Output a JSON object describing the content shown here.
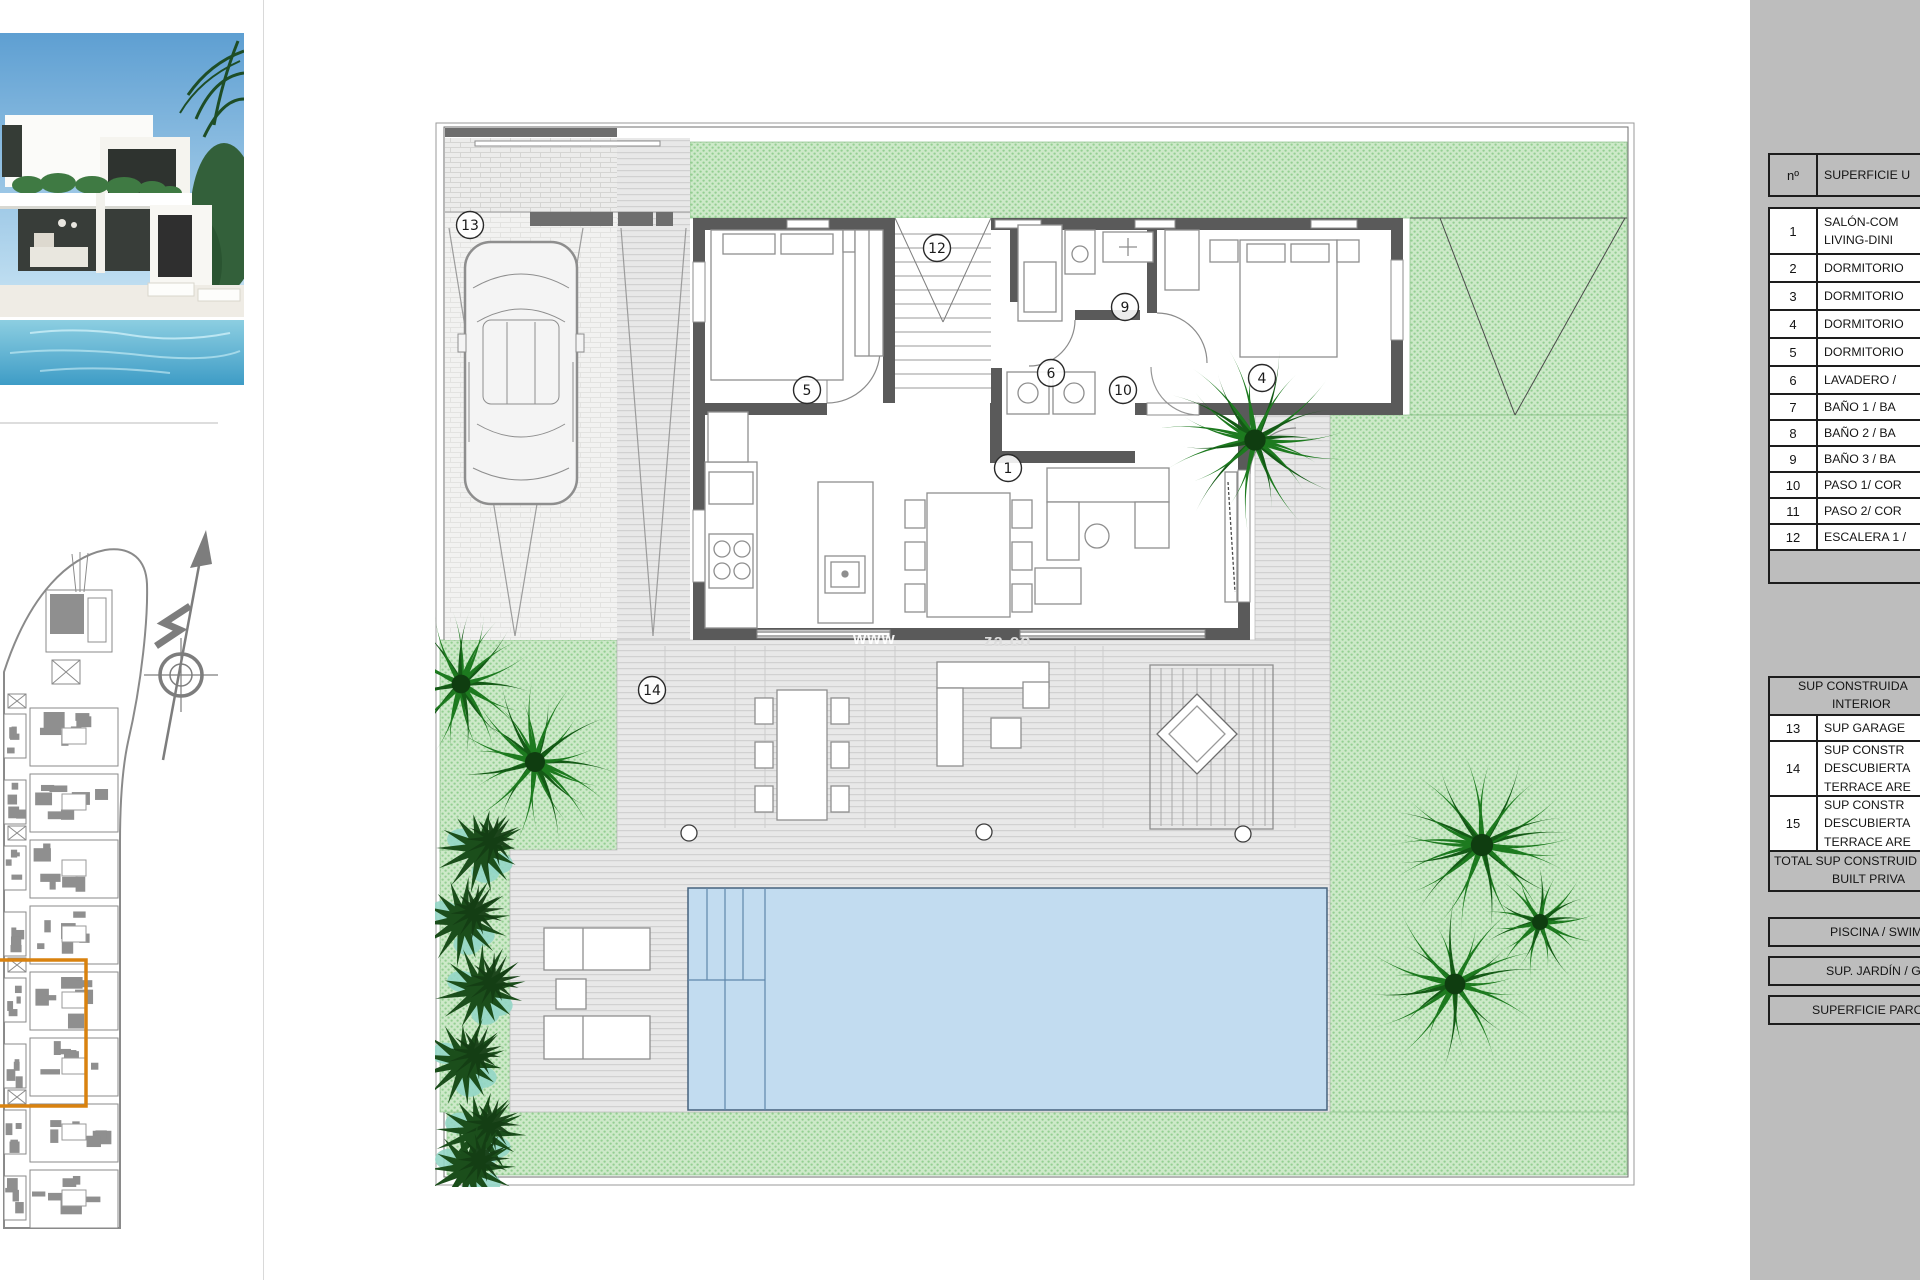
{
  "page": {
    "background": "#ffffff"
  },
  "photo": {
    "description": "modern white villa with swimming pool and palm tree"
  },
  "site_plan": {
    "highlight_color": "#d9820f"
  },
  "plan": {
    "watermark": {
      "left": "www",
      "right": "za.co"
    },
    "colors": {
      "garden": "#cde9c9",
      "garden_dot": "#94cf92",
      "pool": "#c2dcf0",
      "wall": "#5a5a5a",
      "deck": "#e8e8e8",
      "palm": "#1d7a1f",
      "shrub": "#1b4e1b",
      "teal_accent": "#93d6c6"
    },
    "labels": [
      {
        "n": "1",
        "x": 573,
        "y": 346
      },
      {
        "n": "4",
        "x": 827,
        "y": 256
      },
      {
        "n": "5",
        "x": 372,
        "y": 268
      },
      {
        "n": "6",
        "x": 616,
        "y": 251
      },
      {
        "n": "9",
        "x": 690,
        "y": 185
      },
      {
        "n": "10",
        "x": 688,
        "y": 268
      },
      {
        "n": "12",
        "x": 502,
        "y": 126
      },
      {
        "n": "13",
        "x": 35,
        "y": 103
      },
      {
        "n": "14",
        "x": 217,
        "y": 568
      }
    ]
  },
  "area_table": {
    "panel_color": "#bdbdbd",
    "header": {
      "num": "nº",
      "name": "SUPERFICIE U"
    },
    "rooms": [
      {
        "num": "1",
        "lines": [
          "SALÓN-COM",
          "LIVING-DINI"
        ]
      },
      {
        "num": "2",
        "lines": [
          "DORMITORIO"
        ]
      },
      {
        "num": "3",
        "lines": [
          "DORMITORIO"
        ]
      },
      {
        "num": "4",
        "lines": [
          "DORMITORIO"
        ]
      },
      {
        "num": "5",
        "lines": [
          "DORMITORIO"
        ]
      },
      {
        "num": "6",
        "lines": [
          "LAVADERO /"
        ]
      },
      {
        "num": "7",
        "lines": [
          "BAÑO 1 / BA"
        ]
      },
      {
        "num": "8",
        "lines": [
          "BAÑO 2 / BA"
        ]
      },
      {
        "num": "9",
        "lines": [
          "BAÑO 3 / BA"
        ]
      },
      {
        "num": "10",
        "lines": [
          "PASO 1/ COR"
        ]
      },
      {
        "num": "11",
        "lines": [
          "PASO 2/ COR"
        ]
      },
      {
        "num": "12",
        "lines": [
          "ESCALERA 1 /"
        ]
      }
    ],
    "section2_header": [
      "SUP CONSTRUIDA",
      "INTERIOR"
    ],
    "rooms2": [
      {
        "num": "13",
        "lines": [
          "SUP GARAGE"
        ]
      },
      {
        "num": "14",
        "lines": [
          "SUP CONSTR",
          "DESCUBIERTA",
          "TERRACE ARE"
        ]
      },
      {
        "num": "15",
        "lines": [
          "SUP CONSTR",
          "DESCUBIERTA",
          "TERRACE ARE"
        ]
      }
    ],
    "total_lines": [
      "TOTAL SUP CONSTRUID",
      "BUILT PRIVA"
    ],
    "footer_rows": [
      "PISCINA / SWIM",
      "SUP. JARDÍN / G",
      "SUPERFICIE PARCE"
    ]
  }
}
